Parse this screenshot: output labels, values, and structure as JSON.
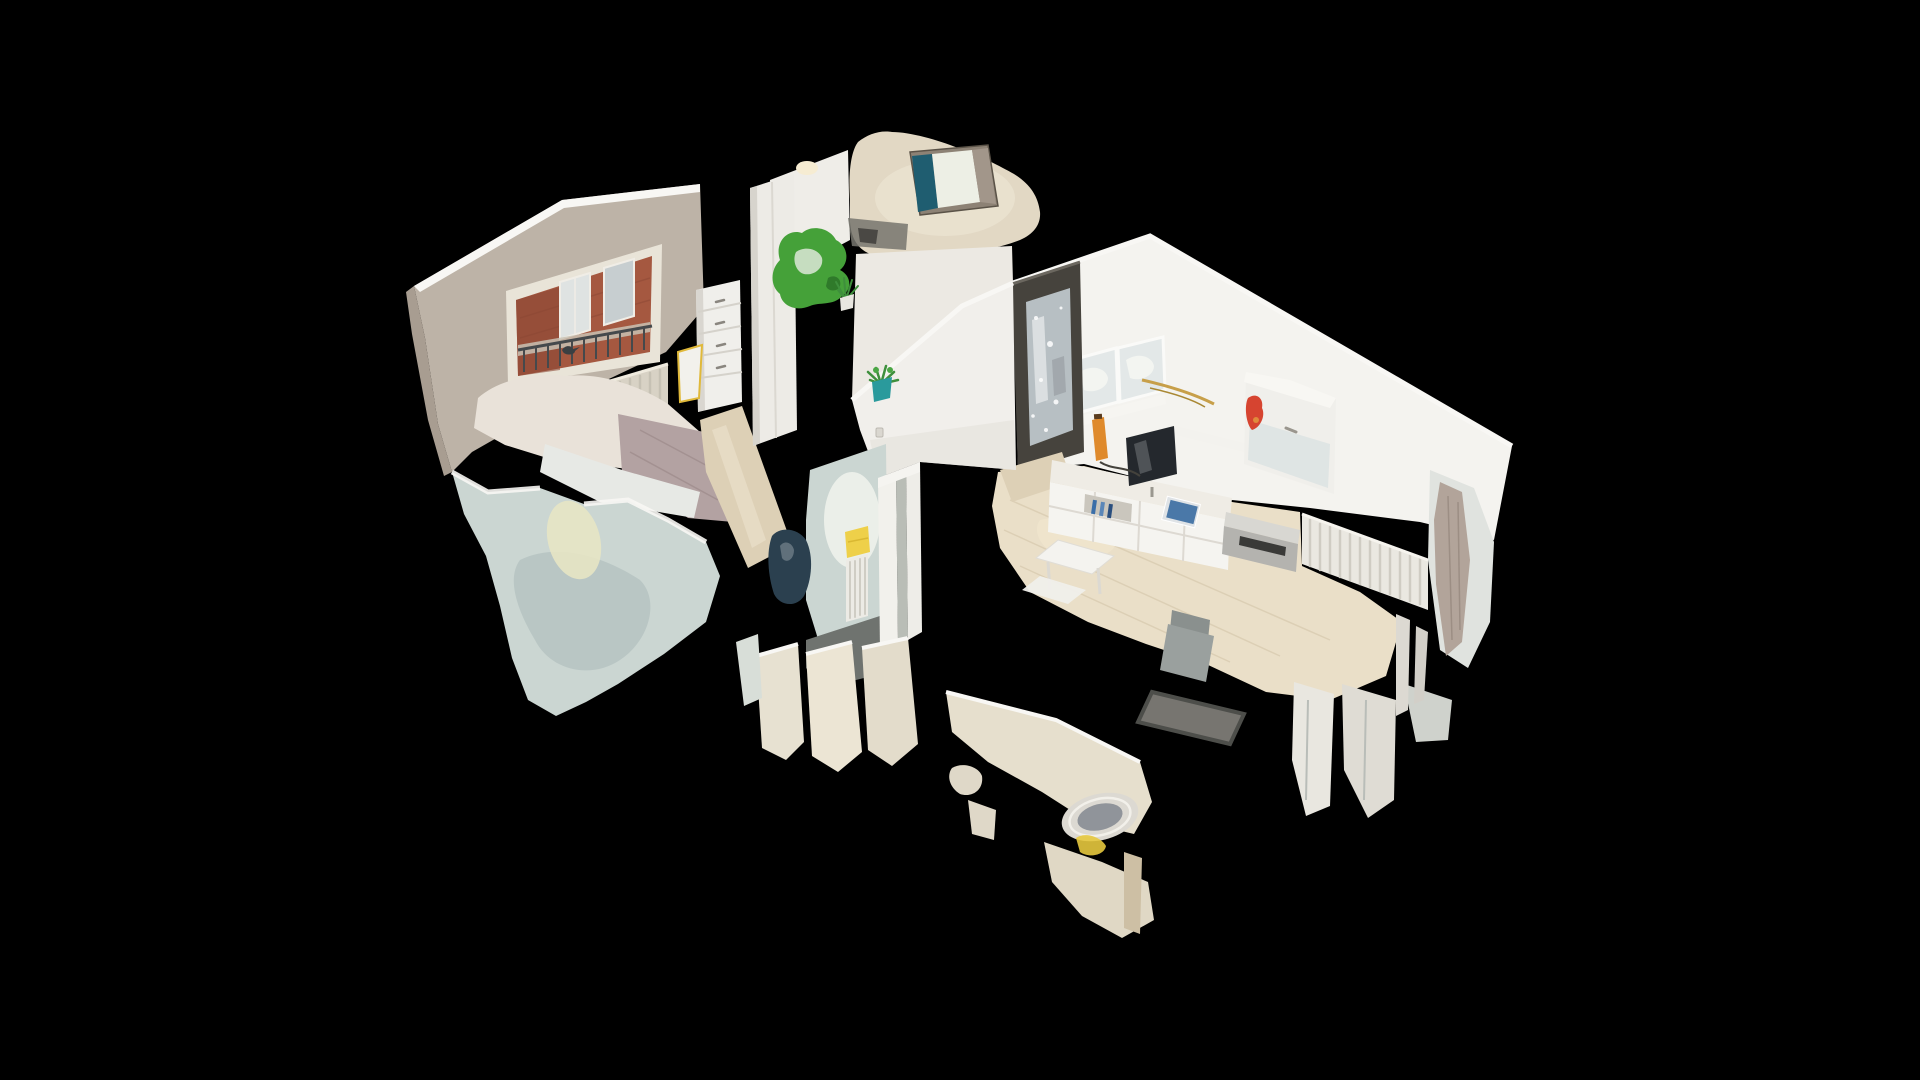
{
  "canvas": {
    "width": 1920,
    "height": 1080
  },
  "viewer": {
    "mode_label": "dollhouse-cutaway-3d-view"
  },
  "palette": {
    "background": "#000000",
    "wall_beige": "#bdb3a7",
    "wall_beige_dark": "#a89d91",
    "wall_cream": "#e2d8c4",
    "wall_white": "#f4f3ef",
    "cut_top_white": "#f8f7f4",
    "cut_wall_pale": "#cbd6d2",
    "cut_wall_pale_dark": "#b4c2c0",
    "floor_wood": "#ddd0b6",
    "floor_wood_light": "#eadfc8",
    "brick_red": "#a55840",
    "railing_dark": "#45494c",
    "door_dark": "#46433d",
    "door_glass": "#b7bfc3",
    "green_accent": "#45a139",
    "green_plant": "#3e8f3c",
    "teal_pot": "#2a9a9c",
    "yellow_warn": "#f1c41f",
    "yellow_towel": "#eed049",
    "tv_screen": "#24282d",
    "gold": "#c79f49",
    "red_accent": "#d64430",
    "orange_accent": "#df8a2c",
    "navy_object": "#2b404f",
    "radiator_white": "#eae8e1",
    "mauve_blanket": "#b3a2a2",
    "art_teal": "#1f5d70",
    "dark_floor": "#6f736f"
  },
  "scene": {
    "rooms": [
      {
        "name": "bedroom",
        "elements": [
          "street-window",
          "balcony-railing",
          "bird",
          "radiator",
          "double-bed",
          "chest-of-drawers",
          "ironing-board",
          "cut-wall"
        ]
      },
      {
        "name": "hallway",
        "elements": [
          "wardrobe",
          "green-coat-rack",
          "fern-plant",
          "potted-plant",
          "entrance-door",
          "electric-warning-sign",
          "light-switch"
        ]
      },
      {
        "name": "entry-room",
        "elements": [
          "blue-wall-art",
          "ceiling-lamp"
        ]
      },
      {
        "name": "living-room",
        "elements": [
          "wall-shelf-unit",
          "wall-cabinet",
          "gold-wall-decor",
          "red-wall-decor",
          "tv",
          "media-console",
          "magazines",
          "printer",
          "radiator",
          "side-tables",
          "chair",
          "glass-panel"
        ]
      },
      {
        "name": "bathroom",
        "elements": [
          "door-frame",
          "radiator",
          "yellow-towel",
          "dark-object",
          "toilet"
        ]
      }
    ]
  }
}
